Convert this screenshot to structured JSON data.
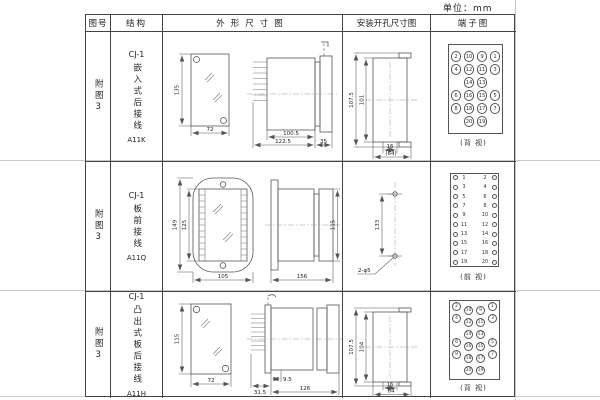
{
  "unit_label": "单位：mm",
  "headers": {
    "fig_no": "图号",
    "structure": "结构",
    "outline": "外形尺寸图",
    "mounting": "安装开孔尺寸图",
    "terminal": "端子图"
  },
  "rows": [
    {
      "fig_no": "附图3",
      "model": "CJ-1",
      "mount_text": "嵌入式后接线",
      "code": "A11K",
      "outline": {
        "front_h": "135",
        "front_w": "72",
        "side_d1": "100.5",
        "side_d2": "122.5",
        "side_d3": "35"
      },
      "mounting": {
        "outer": "107.5",
        "inner": "101",
        "slot": "16",
        "span": "(64)"
      },
      "terminal": {
        "caption": "(背 视)",
        "grid": [
          [
            "2",
            "10",
            "9",
            "1"
          ],
          [
            "4",
            "12",
            "11",
            "3"
          ],
          [
            "",
            "14",
            "13",
            ""
          ],
          [
            "6",
            "16",
            "15",
            "5"
          ],
          [
            "8",
            "18",
            "17",
            "7"
          ],
          [
            "",
            "20",
            "19",
            ""
          ]
        ]
      }
    },
    {
      "fig_no": "附图3",
      "model": "CJ-1",
      "mount_text": "板前接线",
      "code": "A11Q",
      "outline": {
        "front_h1": "149",
        "front_h2": "125",
        "front_w": "105",
        "side_len": "156",
        "side_h": "115"
      },
      "mounting": {
        "pitch": "133",
        "holes": "2-φ5"
      },
      "terminal": {
        "caption": "(前 视)",
        "left": [
          "1",
          "3",
          "5",
          "7",
          "9",
          "11",
          "13",
          "15",
          "17",
          "19"
        ],
        "right": [
          "2",
          "4",
          "6",
          "8",
          "10",
          "12",
          "14",
          "16",
          "18",
          "20"
        ]
      }
    },
    {
      "fig_no": "附图3",
      "model": "CJ-1",
      "mount_text": "凸出式板后接线",
      "code": "A11H",
      "outline": {
        "front_h": "115",
        "front_w": "72",
        "side_d1": "31.5",
        "side_d2": "9.5",
        "side_d3": "126"
      },
      "mounting": {
        "outer": "107.5",
        "inner": "104",
        "slot": "16",
        "span": "64"
      },
      "terminal": {
        "caption": "(背 视)",
        "grid": [
          [
            "2",
            "10",
            "9",
            "1"
          ],
          [
            "4",
            "12",
            "11",
            "3"
          ],
          [
            "",
            "14",
            "13",
            ""
          ],
          [
            "6",
            "16",
            "15",
            "5"
          ],
          [
            "8",
            "18",
            "17",
            "7"
          ],
          [
            "",
            "20",
            "19",
            ""
          ]
        ]
      }
    }
  ]
}
